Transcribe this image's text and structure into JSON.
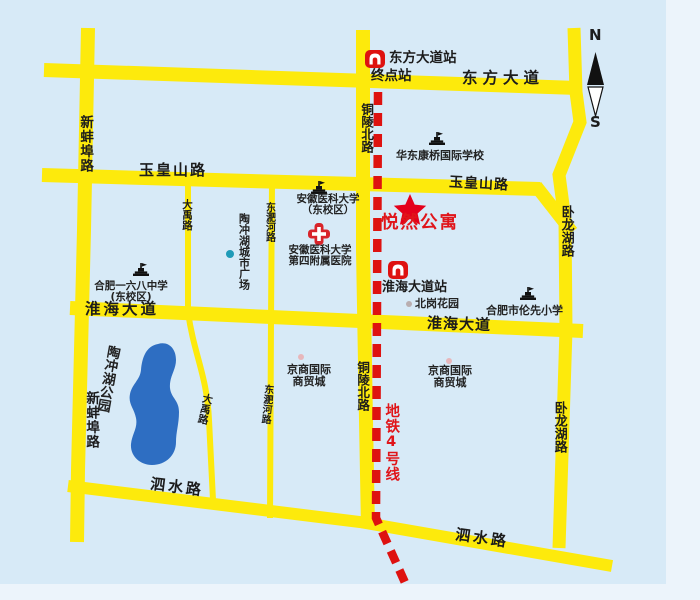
{
  "colors": {
    "background": "#d7eaf7",
    "road_yellow": "#fdea0c",
    "lake_blue": "#2e6ec2",
    "metro_red": "#de1210",
    "accent_red": "#e0151a"
  },
  "compass": {
    "north": "N",
    "south": "S"
  },
  "roads": {
    "dongfang_dadao": "东方大道",
    "yuhuangshan_lu": "玉皇山路",
    "huaihai_dadao": "淮海大道",
    "sishui_lu": "泗水路",
    "xinbengbu_lu": "新蚌埠路",
    "tonglingbei_lu": "铜陵北路",
    "dongfeihe_lu": "东淝河路",
    "dayu_lu": "大禹路",
    "wolonghu_lu": "卧龙湖路"
  },
  "metro": {
    "line_label": "地铁4号线",
    "station_dongfang": "东方大道站",
    "station_dongfang_sub": "终点站",
    "station_huaihai": "淮海大道站"
  },
  "highlight": {
    "name": "悦然公寓"
  },
  "pois": {
    "huadong_school": "华东康桥国际学校",
    "anyida_line1": "安徽医科大学",
    "anyida_line2": "（东校区）",
    "hospital_line1": "安徽医科大学",
    "hospital_line2": "第四附属医院",
    "school168_line1": "合肥一六八中学",
    "school168_line2": "(东校区)",
    "lunxian_school": "合肥市伦先小学",
    "beigang_garden": "北岗花园",
    "jingshang_line1": "京商国际",
    "jingshang_line2": "商贸城",
    "taochonghu_plaza": "陶冲湖城市广场",
    "taochonghu_park": "陶冲湖公园"
  }
}
